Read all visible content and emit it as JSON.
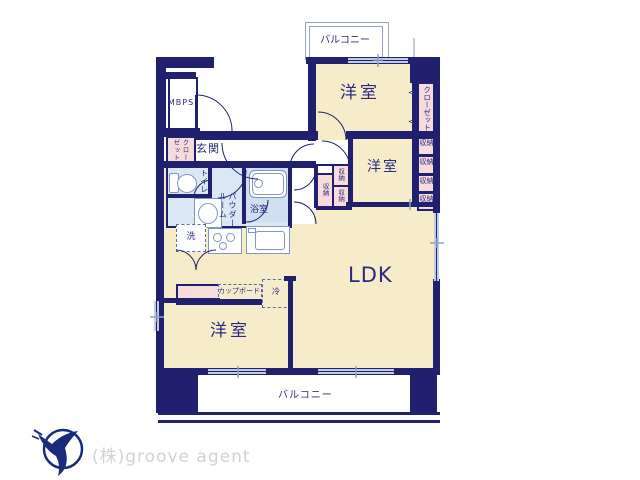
{
  "plan": {
    "balcony_top": "バルコニー",
    "balcony_bottom": "バルコニー",
    "bedroom": "洋室",
    "ldk": "LDK",
    "entrance": "玄関",
    "toilet": "トイレ",
    "powder_col_right": "パウダー",
    "powder_col_left": "ルーム",
    "bathroom": "浴室",
    "washer": "洗",
    "closet": "クローゼット",
    "entrance_closet_col_right": "クロー",
    "entrance_closet_col_left": "ゼット",
    "storage": "収納",
    "cupboard": "カップボード",
    "refrigerator": "冷",
    "mb": "MB",
    "ps": "PS",
    "door_arrow": "<"
  },
  "footer": {
    "company": "(株)groove agent"
  },
  "colors": {
    "wall": "#20206e",
    "room_fill": "#f7ecca",
    "wet_fill": "#dae8f5",
    "closet_fill": "#f8dcdc",
    "text": "#2b2b7e",
    "window": "#c3cde2",
    "balcony_line": "#97a3c4",
    "logo_blue": "#1b2b7b",
    "logo_text": "#d2d2d2"
  }
}
